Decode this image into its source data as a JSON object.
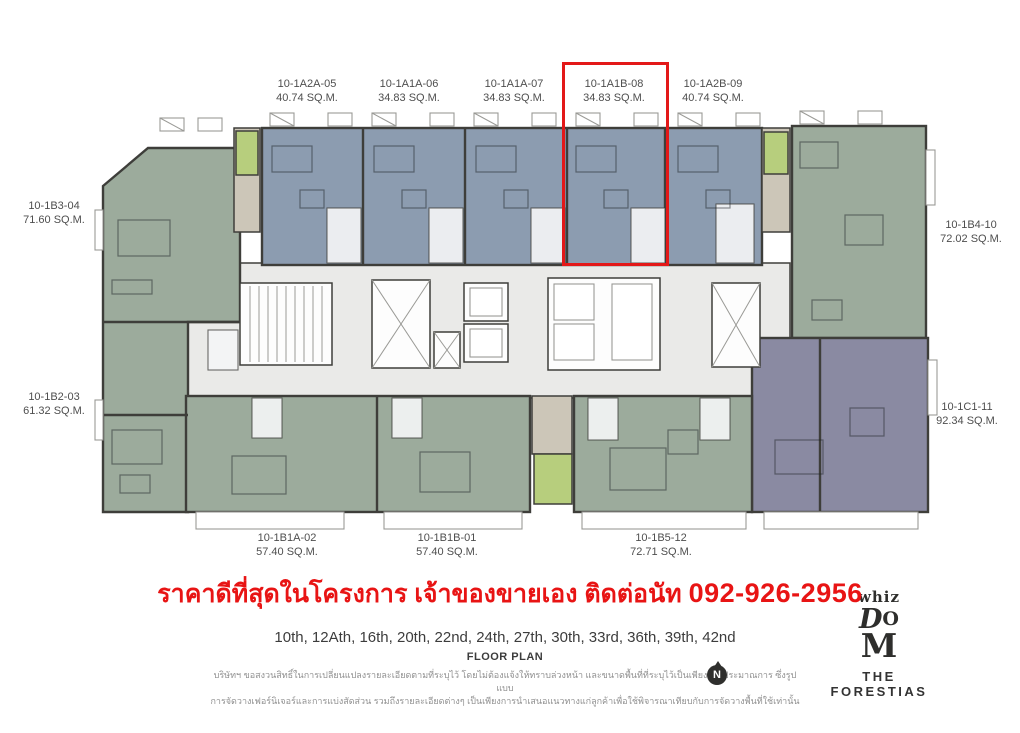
{
  "units": {
    "top": [
      {
        "id": "10-1A2A-05",
        "area": "40.74 SQ.M."
      },
      {
        "id": "10-1A1A-06",
        "area": "34.83 SQ.M."
      },
      {
        "id": "10-1A1A-07",
        "area": "34.83 SQ.M."
      },
      {
        "id": "10-1A1B-08",
        "area": "34.83 SQ.M."
      },
      {
        "id": "10-1A2B-09",
        "area": "40.74 SQ.M."
      }
    ],
    "left": [
      {
        "id": "10-1B3-04",
        "area": "71.60 SQ.M."
      },
      {
        "id": "10-1B2-03",
        "area": "61.32 SQ.M."
      }
    ],
    "right": [
      {
        "id": "10-1B4-10",
        "area": "72.02 SQ.M."
      },
      {
        "id": "10-1C1-11",
        "area": "92.34 SQ.M."
      }
    ],
    "bottom": [
      {
        "id": "10-1B1A-02",
        "area": "57.40 SQ.M."
      },
      {
        "id": "10-1B1B-01",
        "area": "57.40 SQ.M."
      },
      {
        "id": "10-1B5-12",
        "area": "72.71 SQ.M."
      }
    ]
  },
  "highlight": {
    "unit_id": "10-1A1B-08"
  },
  "promo": {
    "text": "ราคาดีที่สุดในโครงการ เจ้าของขายเอง ติดต่อนัท",
    "phone": "092-926-2956"
  },
  "footer": {
    "floors": "10th, 12Ath, 16th, 20th, 22nd, 24th, 27th, 30th, 33rd, 36th, 39th, 42nd",
    "plan_title": "FLOOR PLAN",
    "disclaimer_line1": "บริษัทฯ ขอสงวนสิทธิ์ในการเปลี่ยนแปลงรายละเอียดตามที่ระบุไว้ โดยไม่ต้องแจ้งให้ทราบล่วงหน้า และขนาดพื้นที่ที่ระบุไว้เป็นเพียงการประมาณการ ซึ่งรูปแบบ",
    "disclaimer_line2": "การจัดวางเฟอร์นิเจอร์และการแบ่งสัดส่วน รวมถึงรายละเอียดต่างๆ เป็นเพียงการนำเสนอแนวทางแก่ลูกค้าเพื่อใช้พิจารณาเทียบกับการจัดวางพื้นที่ใช้เท่านั้น",
    "north_label": "N"
  },
  "logo": {
    "whiz": "whiz",
    "d": "D",
    "o": "O",
    "m": "M",
    "brand": "THE FORESTIAS"
  },
  "colors": {
    "highlight": "#e31818",
    "promo_red": "#e81414",
    "unit_blue": "#8c9cb0",
    "unit_green": "#9cab9c",
    "unit_purple": "#8a8aa2",
    "balcony_green": "#b7ce7d",
    "tan": "#ccc6b8",
    "corridor": "#eaeae8",
    "wall": "#3e3e3a"
  }
}
